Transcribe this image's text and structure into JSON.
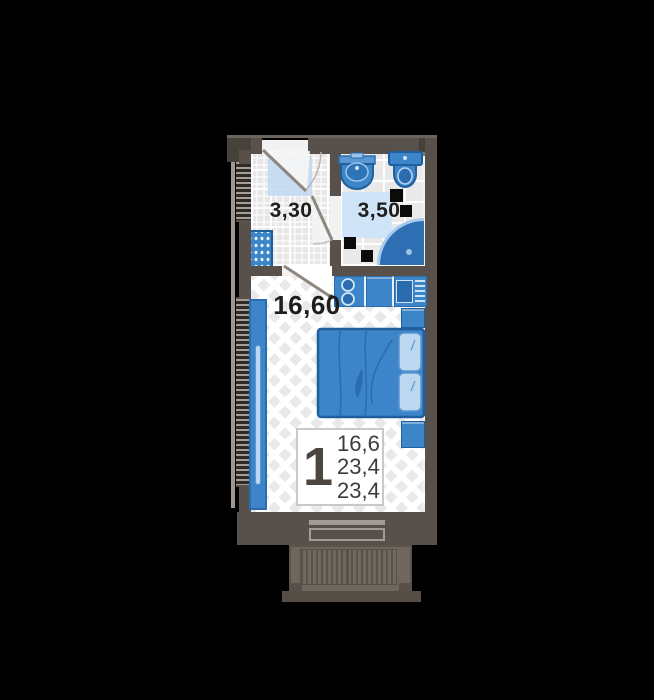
{
  "plan": {
    "type_label": "studio-apartment-floor-plan",
    "rooms": {
      "hall": {
        "area_label": "3,30"
      },
      "bathroom": {
        "area_label": "3,50"
      },
      "living": {
        "area_label": "16,60"
      }
    },
    "info_box": {
      "rooms_count": "1",
      "areas": [
        "16,6",
        "23,4",
        "23,4"
      ]
    },
    "colors": {
      "bg": "#000000",
      "wall": "#57504b",
      "wall_dark": "#474239",
      "accent": "#3c85c8",
      "accent_dark": "#2a6cae",
      "accent_border": "#1f5f9e",
      "light_blue": "#bcd7f0",
      "pale_blue": "#cfe4f6",
      "shower": "#2e6fb4",
      "balcony": "#6e675e",
      "label": "#1d1d1d"
    }
  }
}
